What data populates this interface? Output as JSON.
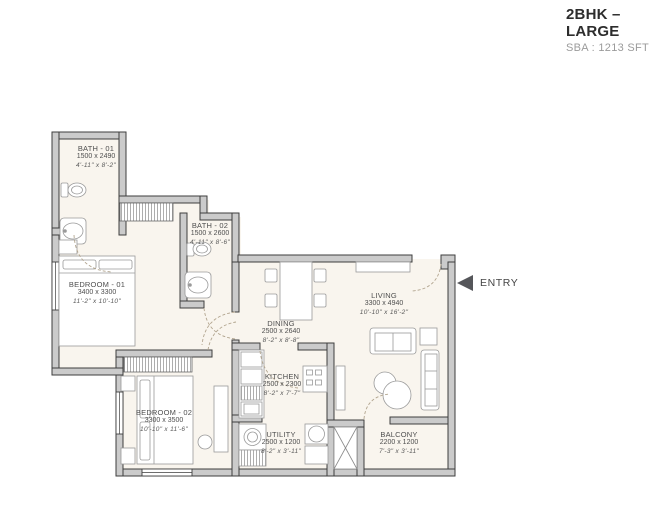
{
  "header": {
    "title": "2BHK – LARGE",
    "subtitle": "SBA : 1213 SFT"
  },
  "entry": {
    "label": "ENTRY"
  },
  "plan": {
    "type": "apartment-floor-plan",
    "rooms": [
      {
        "id": "bath-01",
        "name": "BATH - 01",
        "size_mm": "1500 x 2490",
        "size_ft": "4'-11\" x 8'-2\""
      },
      {
        "id": "bath-02",
        "name": "BATH - 02",
        "size_mm": "1500 x 2600",
        "size_ft": "4'-11\" x 8'-6\""
      },
      {
        "id": "bedroom-01",
        "name": "BEDROOM - 01",
        "size_mm": "3400 x 3300",
        "size_ft": "11'-2\" x 10'-10\""
      },
      {
        "id": "dining",
        "name": "DINING",
        "size_mm": "2500 x 2640",
        "size_ft": "8'-2\" x 8'-8\""
      },
      {
        "id": "living",
        "name": "LIVING",
        "size_mm": "3300 x 4940",
        "size_ft": "10'-10\" x 16'-2\""
      },
      {
        "id": "kitchen",
        "name": "KITCHEN",
        "size_mm": "2500 x 2300",
        "size_ft": "8'-2\" x 7'-7\""
      },
      {
        "id": "bedroom-02",
        "name": "BEDROOM - 02",
        "size_mm": "3300 x 3500",
        "size_ft": "10'-10\" x 11'-6\""
      },
      {
        "id": "utility",
        "name": "UTILITY",
        "size_mm": "2500 x 1200",
        "size_ft": "8'-2\" x 3'-11\""
      },
      {
        "id": "balcony",
        "name": "BALCONY",
        "size_mm": "2200 x 1200",
        "size_ft": "7'-3\" x 3'-11\""
      }
    ]
  },
  "colors": {
    "wall_fill": "#cbcbcb",
    "wall_stroke": "#3e3e3e",
    "floor": "#f9f5ee",
    "furniture_line": "#9a9a9a",
    "door_arc": "#b2a58f",
    "hatch": "#8a8a8a",
    "label_text": "#4f4f4f",
    "title_text": "#2d2d2d",
    "subtitle_text": "#9b9b9b",
    "entry_arrow": "#55565a"
  }
}
